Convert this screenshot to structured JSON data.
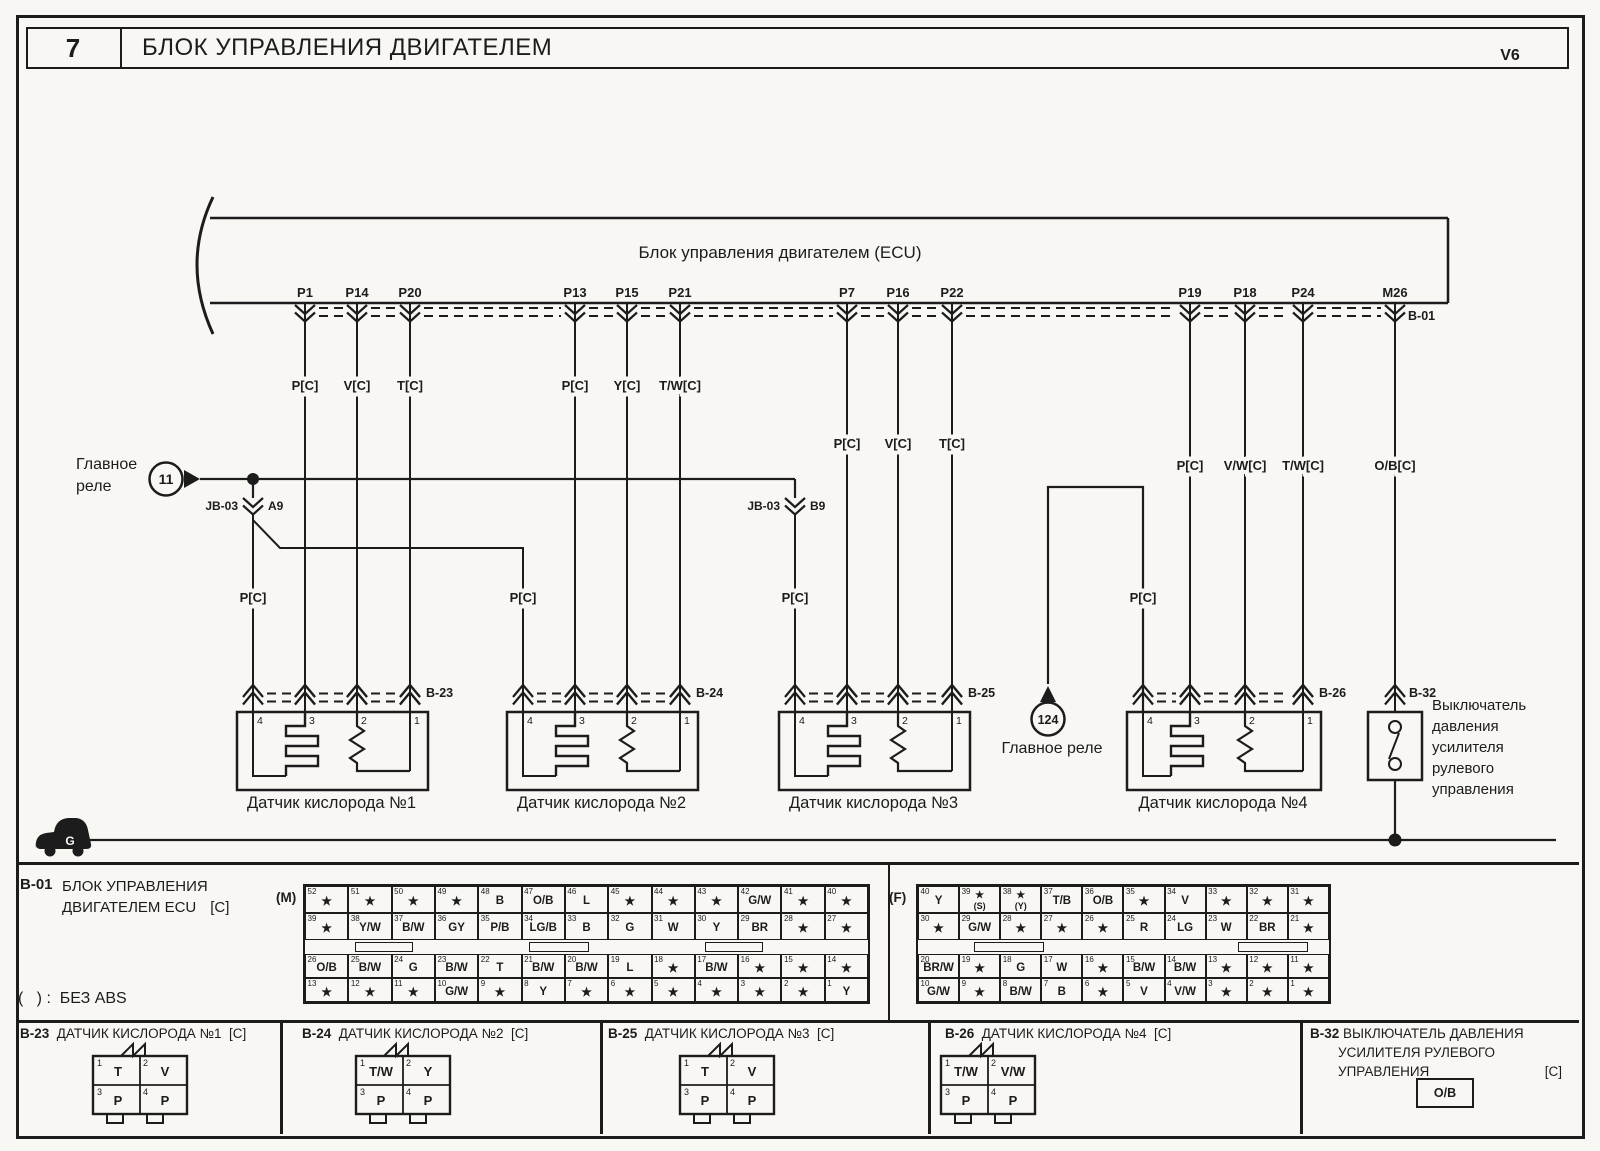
{
  "header": {
    "page_number": "7",
    "title": "БЛОК УПРАВЛЕНИЯ ДВИГАТЕЛЕМ",
    "variant": "V6"
  },
  "colors": {
    "ink": "#1c1c1c",
    "paper": "#f8f7f4"
  },
  "ecu": {
    "label": "Блок управления двигателем (ECU)",
    "connector_id": "B-01"
  },
  "ecu_pins": [
    {
      "name": "P1",
      "x": 305,
      "wire": "P[C]",
      "ly": 390
    },
    {
      "name": "P14",
      "x": 357,
      "wire": "V[C]",
      "ly": 390
    },
    {
      "name": "P20",
      "x": 410,
      "wire": "T[C]",
      "ly": 390
    },
    {
      "name": "P13",
      "x": 575,
      "wire": "P[C]",
      "ly": 390
    },
    {
      "name": "P15",
      "x": 627,
      "wire": "Y[C]",
      "ly": 390
    },
    {
      "name": "P21",
      "x": 680,
      "wire": "T/W[C]",
      "ly": 390
    },
    {
      "name": "P7",
      "x": 847,
      "wire": "P[C]",
      "ly": 448
    },
    {
      "name": "P16",
      "x": 898,
      "wire": "V[C]",
      "ly": 448
    },
    {
      "name": "P22",
      "x": 952,
      "wire": "T[C]",
      "ly": 448
    },
    {
      "name": "P19",
      "x": 1190,
      "wire": "P[C]",
      "ly": 470
    },
    {
      "name": "P18",
      "x": 1245,
      "wire": "V/W[C]",
      "ly": 470
    },
    {
      "name": "P24",
      "x": 1303,
      "wire": "T/W[C]",
      "ly": 470
    },
    {
      "name": "M26",
      "x": 1395,
      "wire": "O/B[C]",
      "ly": 470
    }
  ],
  "relays": {
    "r11_label_lines": [
      "Главное",
      "реле"
    ],
    "r11_number": "11",
    "r124_number": "124",
    "r124_label": "Главное реле",
    "junction_block": "JB-03",
    "jb_pin_a": "A9",
    "jb_pin_b": "B9",
    "feed_wire": "P[C]"
  },
  "sensors": [
    {
      "id": "B-23",
      "label": "Датчик кислорода №1",
      "pins_x": [
        253,
        305,
        357,
        410
      ]
    },
    {
      "id": "B-24",
      "label": "Датчик кислорода №2",
      "pins_x": [
        523,
        575,
        627,
        680
      ]
    },
    {
      "id": "B-25",
      "label": "Датчик кислорода №3",
      "pins_x": [
        795,
        847,
        898,
        952
      ]
    },
    {
      "id": "B-26",
      "label": "Датчик кислорода №4",
      "pins_x": [
        1143,
        1190,
        1245,
        1303
      ]
    }
  ],
  "sensor_pin_numbers": [
    "4",
    "3",
    "2",
    "1"
  ],
  "pressure_switch": {
    "id": "B-32",
    "x": 1395,
    "label_lines": [
      "Выключатель",
      "давления",
      "усилителя",
      "рулевого",
      "управления"
    ]
  },
  "ground": {
    "letter": "G"
  },
  "bottom": {
    "b01_block": {
      "id": "B-01",
      "line1": "БЛОК УПРАВЛЕНИЯ",
      "line2": "ДВИГАТЕЛЕМ ECU",
      "suffix": "[C]"
    },
    "abs_note": "(   ) :  БЕЗ ABS",
    "m_connector": {
      "label": "(M)",
      "rows": [
        [
          {
            "n": "52",
            "v": "★"
          },
          {
            "n": "51",
            "v": "★"
          },
          {
            "n": "50",
            "v": "★"
          },
          {
            "n": "49",
            "v": "★"
          },
          {
            "n": "48",
            "v": "B"
          },
          {
            "n": "47",
            "v": "O/B"
          },
          {
            "n": "46",
            "v": "L"
          },
          {
            "n": "45",
            "v": "★"
          },
          {
            "n": "44",
            "v": "★"
          },
          {
            "n": "43",
            "v": "★"
          },
          {
            "n": "42",
            "v": "G/W"
          },
          {
            "n": "41",
            "v": "★"
          },
          {
            "n": "40",
            "v": "★"
          }
        ],
        [
          {
            "n": "39",
            "v": "★"
          },
          {
            "n": "38",
            "v": "Y/W"
          },
          {
            "n": "37",
            "v": "B/W"
          },
          {
            "n": "36",
            "v": "GY"
          },
          {
            "n": "35",
            "v": "P/B"
          },
          {
            "n": "34",
            "v": "LG/B"
          },
          {
            "n": "33",
            "v": "B"
          },
          {
            "n": "32",
            "v": "G"
          },
          {
            "n": "31",
            "v": "W"
          },
          {
            "n": "30",
            "v": "Y"
          },
          {
            "n": "29",
            "v": "BR"
          },
          {
            "n": "28",
            "v": "★"
          },
          {
            "n": "27",
            "v": "★"
          }
        ],
        [
          {
            "n": "26",
            "v": "O/B"
          },
          {
            "n": "25",
            "v": "B/W"
          },
          {
            "n": "24",
            "v": "G"
          },
          {
            "n": "23",
            "v": "B/W"
          },
          {
            "n": "22",
            "v": "T"
          },
          {
            "n": "21",
            "v": "B/W"
          },
          {
            "n": "20",
            "v": "B/W"
          },
          {
            "n": "19",
            "v": "L"
          },
          {
            "n": "18",
            "v": "★"
          },
          {
            "n": "17",
            "v": "B/W"
          },
          {
            "n": "16",
            "v": "★"
          },
          {
            "n": "15",
            "v": "★"
          },
          {
            "n": "14",
            "v": "★"
          }
        ],
        [
          {
            "n": "13",
            "v": "★"
          },
          {
            "n": "12",
            "v": "★"
          },
          {
            "n": "11",
            "v": "★"
          },
          {
            "n": "10",
            "v": "G/W"
          },
          {
            "n": "9",
            "v": "★"
          },
          {
            "n": "8",
            "v": "Y"
          },
          {
            "n": "7",
            "v": "★"
          },
          {
            "n": "6",
            "v": "★"
          },
          {
            "n": "5",
            "v": "★"
          },
          {
            "n": "4",
            "v": "★"
          },
          {
            "n": "3",
            "v": "★"
          },
          {
            "n": "2",
            "v": "★"
          },
          {
            "n": "1",
            "v": "Y"
          }
        ]
      ]
    },
    "f_connector": {
      "label": "(F)",
      "rows": [
        [
          {
            "n": "40",
            "v": "Y"
          },
          {
            "n": "39",
            "v": "★",
            "sub": "(S)"
          },
          {
            "n": "38",
            "v": "★",
            "sub": "(Y)"
          },
          {
            "n": "37",
            "v": "T/B"
          },
          {
            "n": "36",
            "v": "O/B"
          },
          {
            "n": "35",
            "v": "★"
          },
          {
            "n": "34",
            "v": "V"
          },
          {
            "n": "33",
            "v": "★"
          },
          {
            "n": "32",
            "v": "★"
          },
          {
            "n": "31",
            "v": "★"
          }
        ],
        [
          {
            "n": "30",
            "v": "★"
          },
          {
            "n": "29",
            "v": "G/W"
          },
          {
            "n": "28",
            "v": "★"
          },
          {
            "n": "27",
            "v": "★"
          },
          {
            "n": "26",
            "v": "★"
          },
          {
            "n": "25",
            "v": "R"
          },
          {
            "n": "24",
            "v": "LG"
          },
          {
            "n": "23",
            "v": "W"
          },
          {
            "n": "22",
            "v": "BR"
          },
          {
            "n": "21",
            "v": "★"
          }
        ],
        [
          {
            "n": "20",
            "v": "BR/W"
          },
          {
            "n": "19",
            "v": "★"
          },
          {
            "n": "18",
            "v": "G"
          },
          {
            "n": "17",
            "v": "W"
          },
          {
            "n": "16",
            "v": "★"
          },
          {
            "n": "15",
            "v": "B/W"
          },
          {
            "n": "14",
            "v": "B/W"
          },
          {
            "n": "13",
            "v": "★"
          },
          {
            "n": "12",
            "v": "★"
          },
          {
            "n": "11",
            "v": "★"
          }
        ],
        [
          {
            "n": "10",
            "v": "G/W"
          },
          {
            "n": "9",
            "v": "★"
          },
          {
            "n": "8",
            "v": "B/W"
          },
          {
            "n": "7",
            "v": "B"
          },
          {
            "n": "6",
            "v": "★"
          },
          {
            "n": "5",
            "v": "V"
          },
          {
            "n": "4",
            "v": "V/W"
          },
          {
            "n": "3",
            "v": "★"
          },
          {
            "n": "2",
            "v": "★"
          },
          {
            "n": "1",
            "v": "★"
          }
        ]
      ]
    },
    "connector_cells": [
      {
        "id": "B-23",
        "title": "ДАТЧИК КИСЛОРОДА №1",
        "suffix": "[C]",
        "cx": 140,
        "cells": [
          {
            "n": "1",
            "v": "T"
          },
          {
            "n": "2",
            "v": "V"
          },
          {
            "n": "3",
            "v": "P"
          },
          {
            "n": "4",
            "v": "P"
          }
        ]
      },
      {
        "id": "B-24",
        "title": "ДАТЧИК КИСЛОРОДА №2",
        "suffix": "[C]",
        "cx": 403,
        "cells": [
          {
            "n": "1",
            "v": "T/W"
          },
          {
            "n": "2",
            "v": "Y"
          },
          {
            "n": "3",
            "v": "P"
          },
          {
            "n": "4",
            "v": "P"
          }
        ]
      },
      {
        "id": "B-25",
        "title": "ДАТЧИК КИСЛОРОДА №3",
        "suffix": "[C]",
        "cx": 727,
        "cells": [
          {
            "n": "1",
            "v": "T"
          },
          {
            "n": "2",
            "v": "V"
          },
          {
            "n": "3",
            "v": "P"
          },
          {
            "n": "4",
            "v": "P"
          }
        ]
      },
      {
        "id": "B-26",
        "title": "ДАТЧИК КИСЛОРОДА №4",
        "suffix": "[C]",
        "cx": 988,
        "cells": [
          {
            "n": "1",
            "v": "T/W"
          },
          {
            "n": "2",
            "v": "V/W"
          },
          {
            "n": "3",
            "v": "P"
          },
          {
            "n": "4",
            "v": "P"
          }
        ]
      }
    ],
    "b32_cell": {
      "id": "B-32",
      "title_lines": [
        "ВЫКЛЮЧАТЕЛЬ ДАВЛЕНИЯ",
        "УСИЛИТЕЛЯ РУЛЕВОГО",
        "УПРАВЛЕНИЯ"
      ],
      "suffix": "[C]",
      "cell_value": "O/B"
    }
  }
}
